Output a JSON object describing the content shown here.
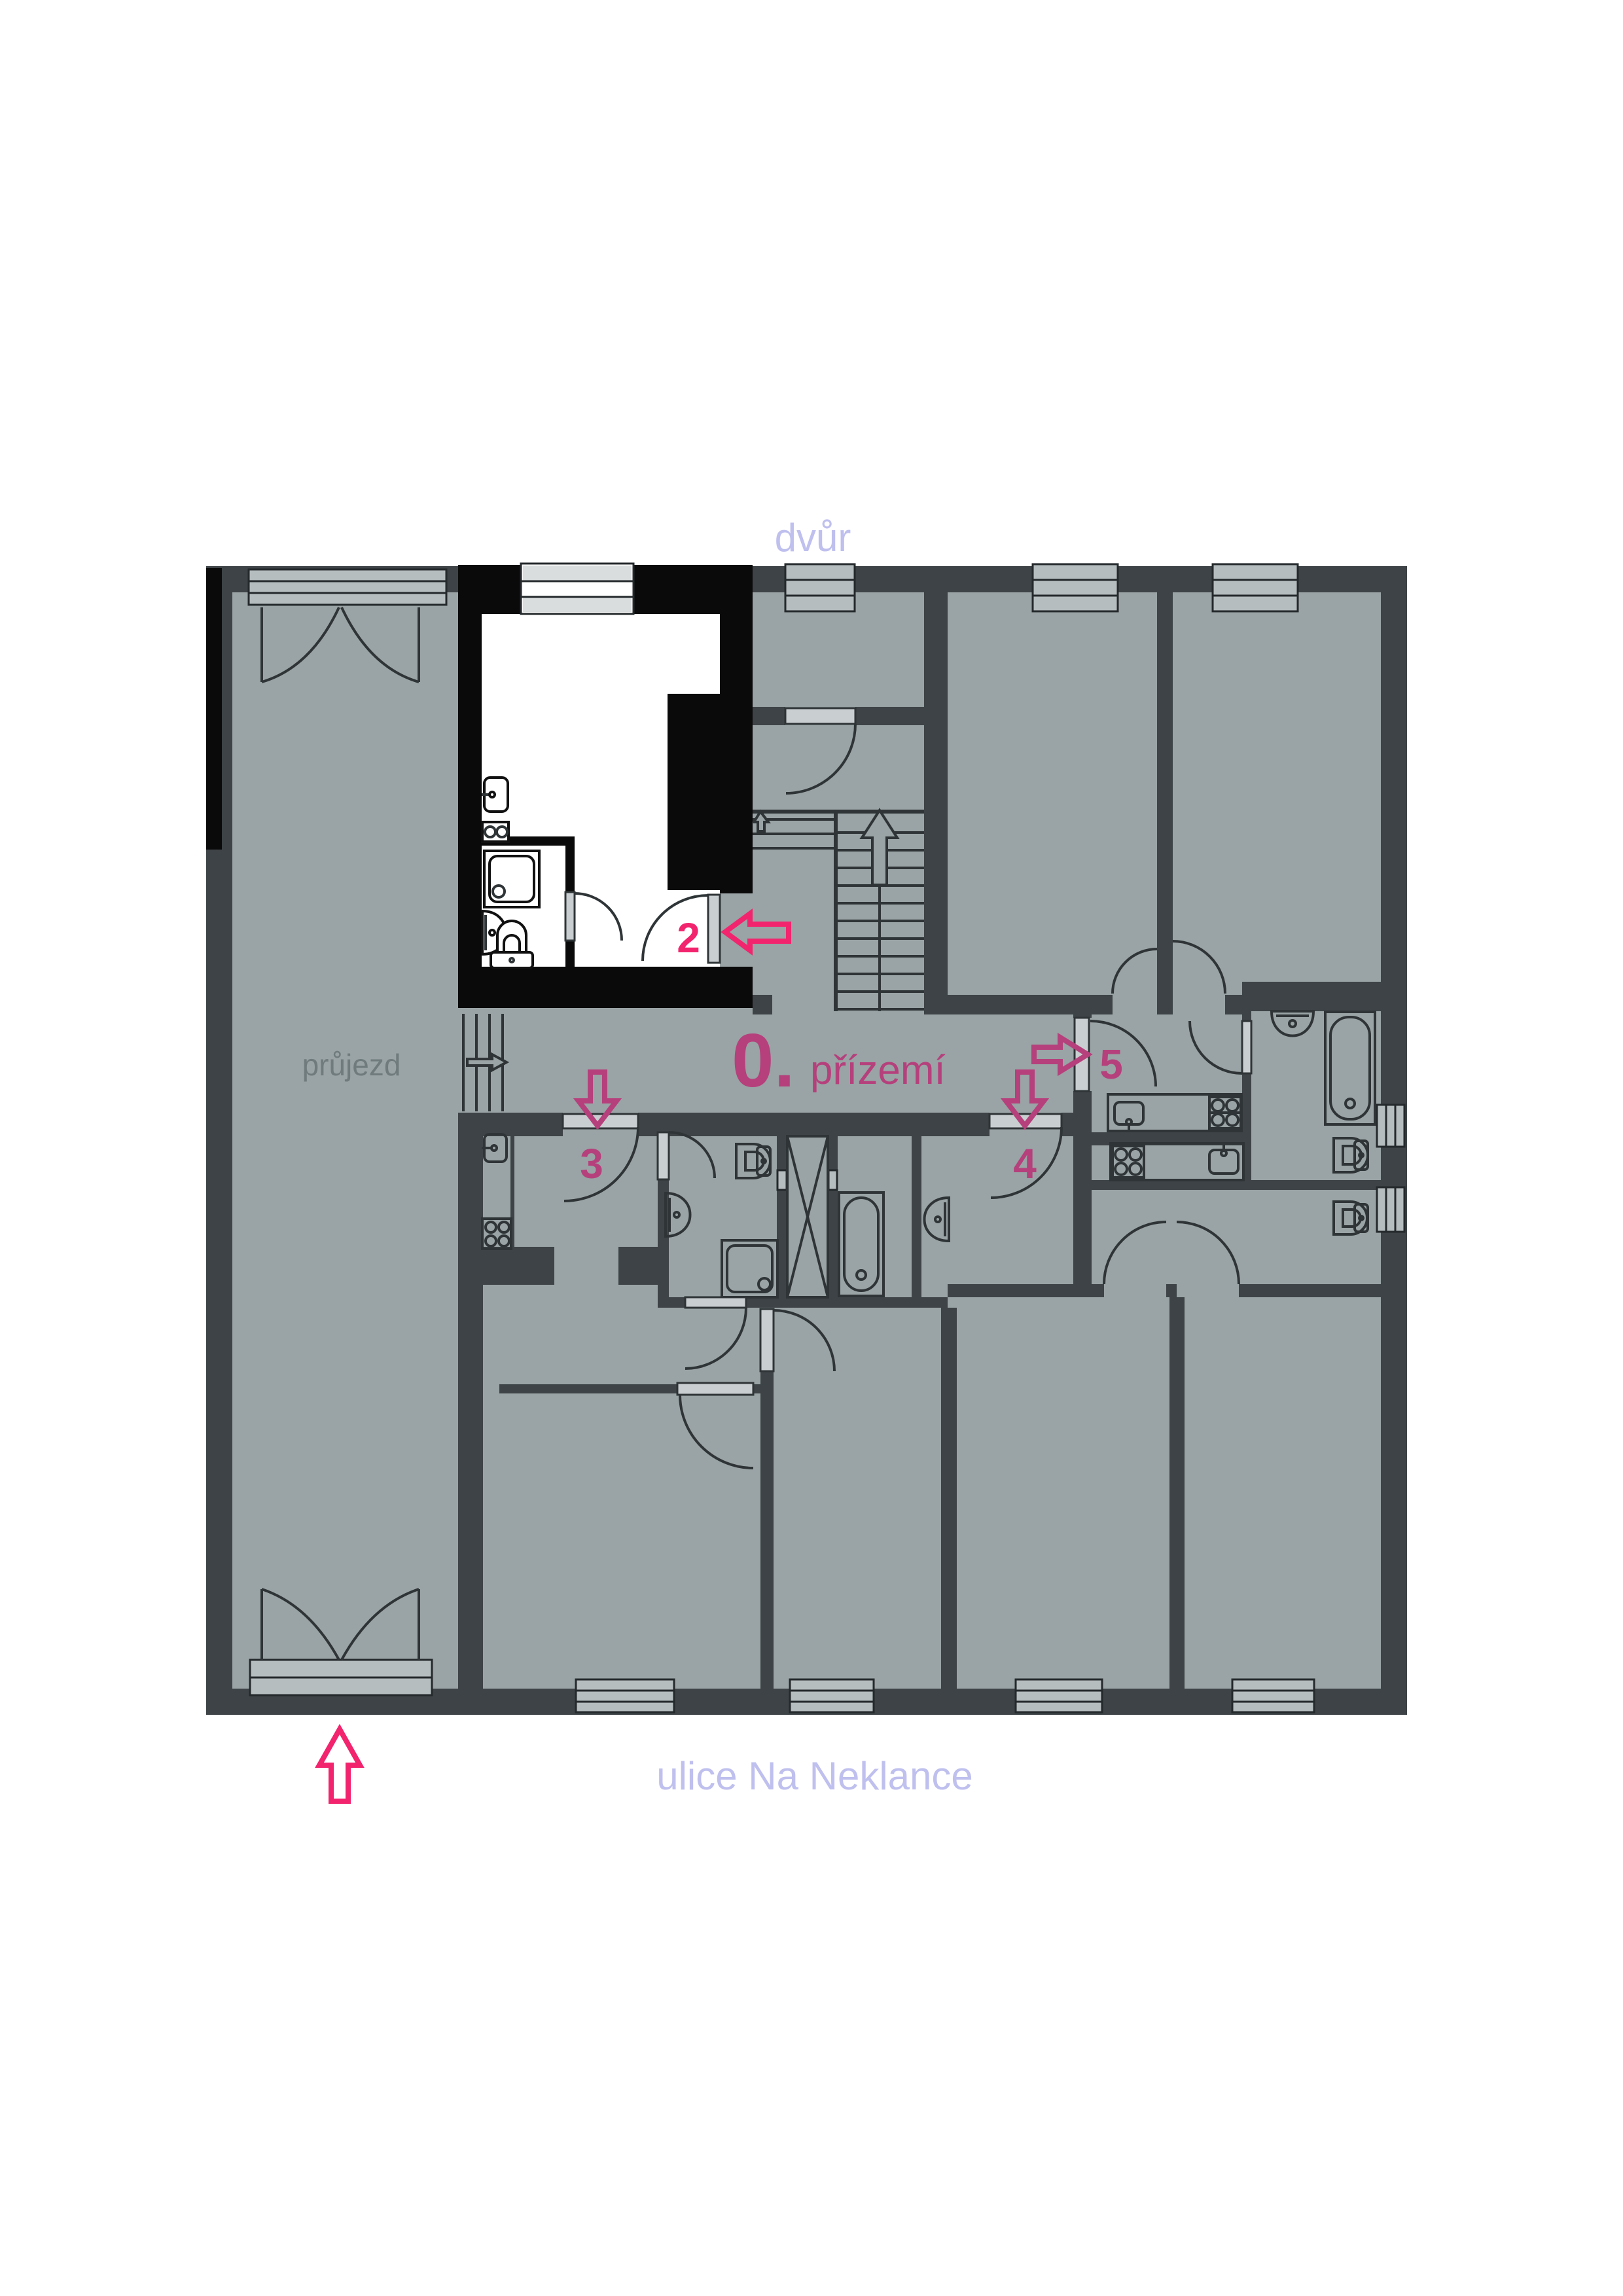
{
  "labels": {
    "top_street": "dvůr",
    "bottom_street": "ulice Na Neklance",
    "passage": "průjezd",
    "floor_number": "0.",
    "floor_name": "přízemí",
    "unit_2": "2",
    "unit_3": "3",
    "unit_4": "4",
    "unit_5": "5"
  },
  "colors": {
    "floor": "#9aa3a5",
    "wall": "#3d4346",
    "black-wall": "#0a0a0a",
    "street-label": "#bfc0ee",
    "passage-label": "#6f7b7d",
    "floor-label": "#b5407c",
    "unit-number": "#b5407c",
    "highlight-unit-number": "#f2246d",
    "entry-arrow": "#f2246d",
    "door-leaf": "#c9ced0",
    "window": "#b6bdbf",
    "fixture-line": "#2f3537",
    "white-room": "#ffffff"
  }
}
